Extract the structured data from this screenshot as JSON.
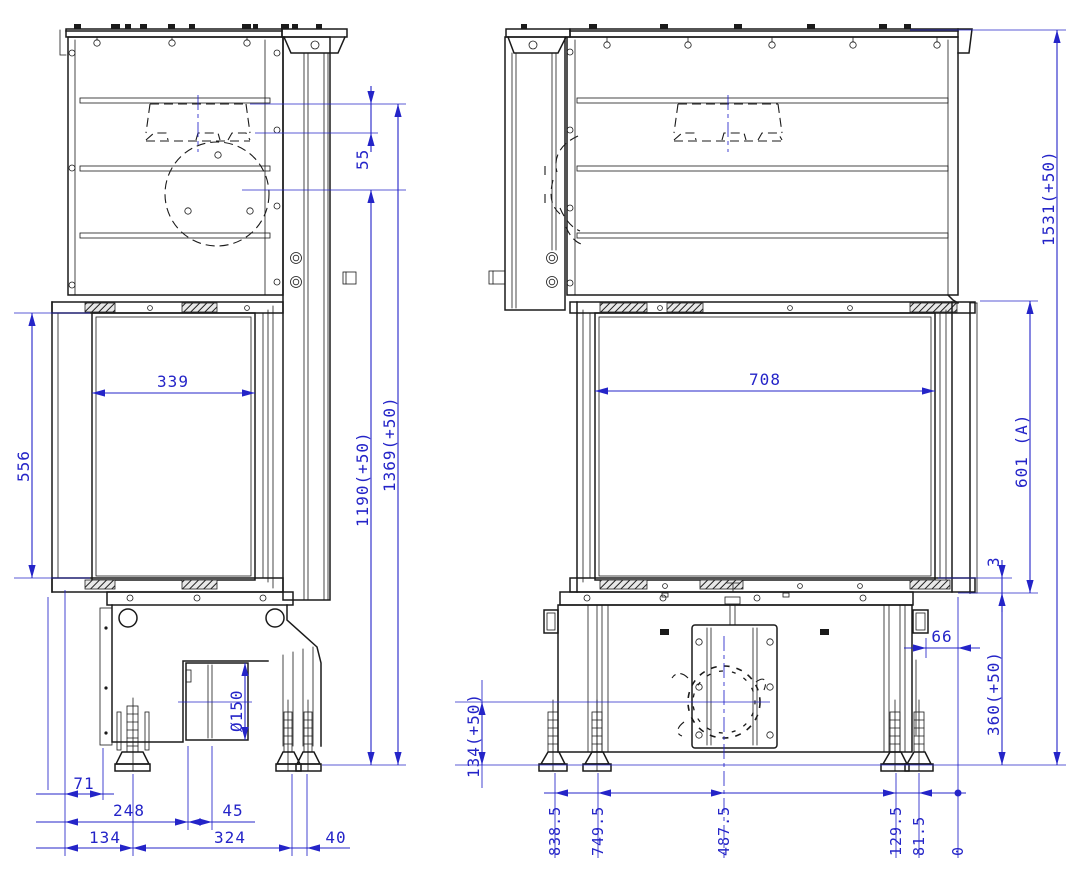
{
  "title": "fireplace-insert-technical-drawing",
  "colors": {
    "line": "#1a1a1a",
    "dimension": "#2424c8",
    "background": "#ffffff"
  },
  "side_view": {
    "dimensions": {
      "flue_drop": "55",
      "glass_width": "339",
      "glass_height": "556",
      "flue_rear_height": "1190(+50)",
      "flue_top_height": "1369(+50)",
      "duct_diameter": "Ø150",
      "front_offset": "71",
      "duct_front_offset": "248",
      "duct_depth": "45",
      "base_front_offset": "134",
      "base_depth": "324",
      "rear_feet_offset": "40"
    }
  },
  "front_view": {
    "dimensions": {
      "glass_width": "708",
      "total_height": "1531(+50)",
      "door_height": "601 (A)",
      "frame_gap": "3",
      "rear_offset": "66",
      "base_height": "360(+50)",
      "duct_axis_height": "134(+50)",
      "ordinates": [
        "838.5",
        "749.5",
        "487.5",
        "129.5",
        "81.5",
        "0"
      ]
    }
  }
}
